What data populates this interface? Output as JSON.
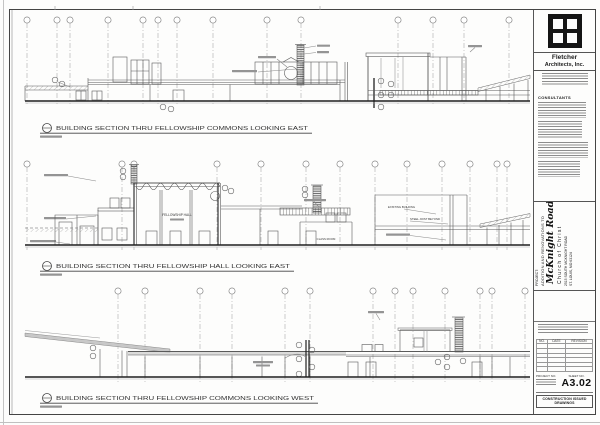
{
  "sheet": {
    "titleblock": {
      "firm_name_line1": "Fletcher",
      "firm_name_line2": "Architects, Inc.",
      "consultants_heading": "CONSULTANTS",
      "project_label": "PROJECT:",
      "project_line1": "ADDITION AND RENOVATIONS TO",
      "project_name": "McKnight Road",
      "project_name2": "Church of Christ",
      "project_addr1": "2515 SOUTH MCKNIGHT ROAD",
      "project_addr2": "ST. LOUIS, MO 63124",
      "revision_table": {
        "headers": [
          "NO.",
          "DATE",
          "REVISION"
        ]
      },
      "project_no_label": "PROJECT NO.",
      "sheet_no_label": "SHEET NO.",
      "sheet_number": "A3.02",
      "issue_note": "CONSTRUCTION ISSUED DRAWINGS"
    },
    "sections": [
      {
        "title": "BUILDING SECTION THRU FELLOWSHIP COMMONS LOOKING EAST"
      },
      {
        "title": "BUILDING SECTION THRU FELLOWSHIP HALL LOOKING EAST",
        "labels": {
          "hall": "FELLOWSHIP HALL",
          "class_room": "CLASS ROOM",
          "existing": "EXISTING BUILDING",
          "joist": "STEEL JOIST BEYOND"
        }
      },
      {
        "title": "BUILDING SECTION THRU FELLOWSHIP COMMONS LOOKING WEST"
      }
    ]
  }
}
